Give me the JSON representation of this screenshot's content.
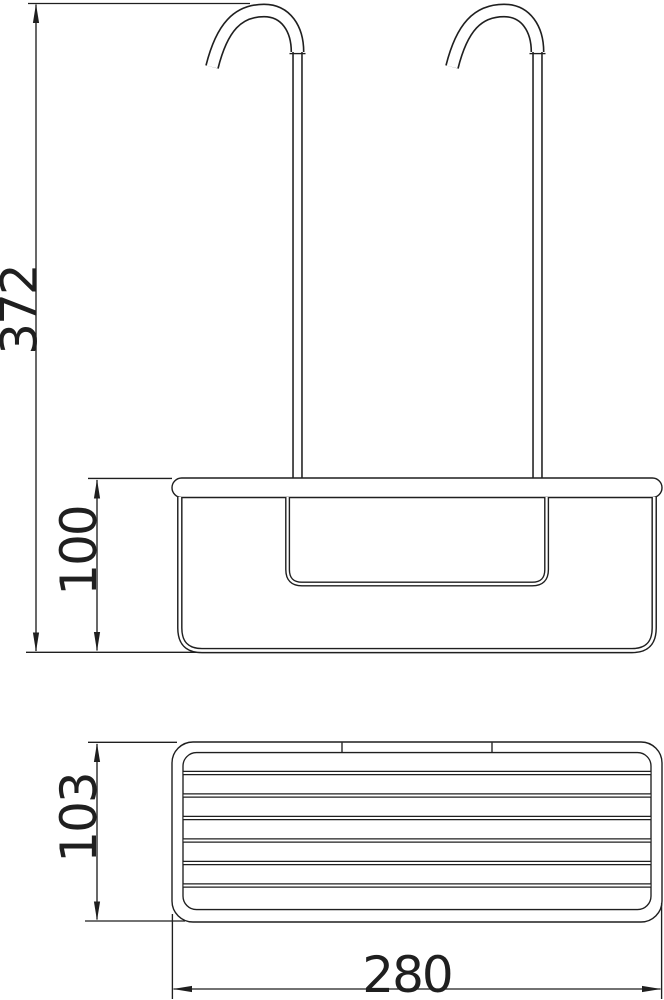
{
  "page": {
    "background": "#ffffff",
    "line_color": "#1f1f1f"
  },
  "drawing": {
    "kind": "technical-dimension-drawing",
    "views": {
      "front": {
        "label": "front view with two hanging hooks"
      },
      "top": {
        "label": "top view of wire basket"
      }
    },
    "counts": {
      "hooks": 2,
      "top_view_wires": 6
    },
    "dimensions": {
      "total_height": {
        "value": "372",
        "orientation": "vertical",
        "view": "front"
      },
      "basket_height": {
        "value": "100",
        "orientation": "vertical",
        "view": "front"
      },
      "basket_depth": {
        "value": "103",
        "orientation": "vertical",
        "view": "top"
      },
      "basket_width": {
        "value": "280",
        "orientation": "horizontal",
        "view": "top"
      }
    }
  }
}
